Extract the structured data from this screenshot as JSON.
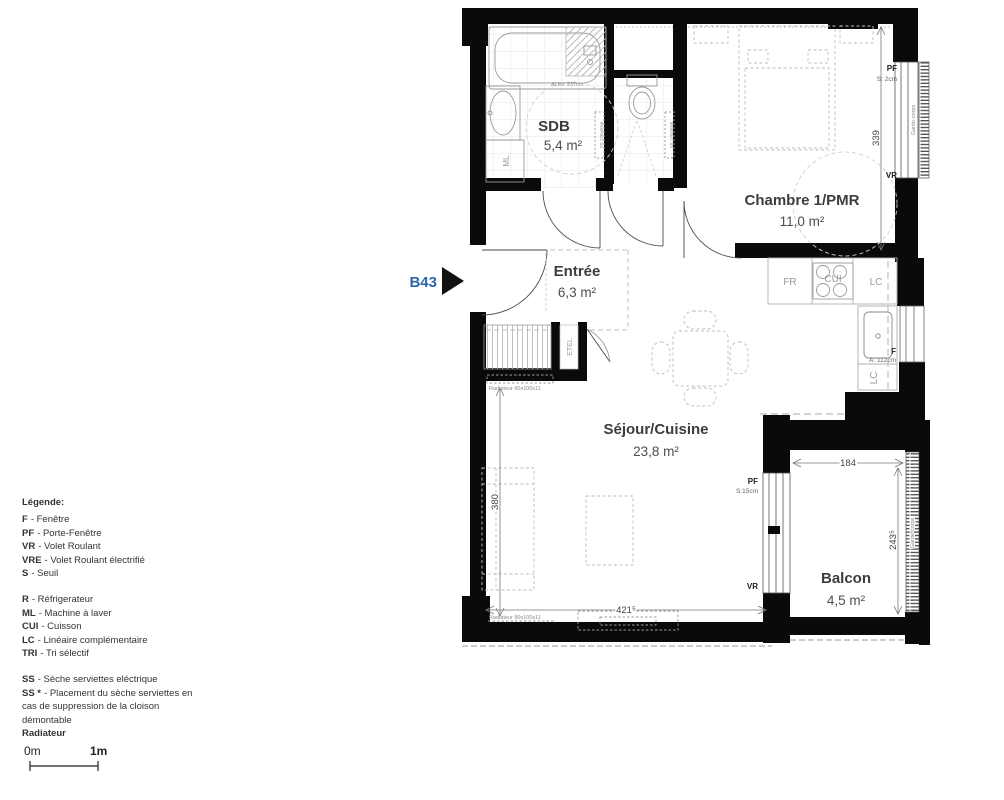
{
  "plan": {
    "unit": "B43",
    "rooms": {
      "sdb": {
        "name": "SDB",
        "area": "5,4 m²"
      },
      "chambre": {
        "name": "Chambre 1/PMR",
        "area": "11,0 m²"
      },
      "entree": {
        "name": "Entrée",
        "area": "6,3 m²"
      },
      "sejour": {
        "name": "Séjour/Cuisine",
        "area": "23,8 m²"
      },
      "balcon": {
        "name": "Balcon",
        "area": "4,5 m²"
      }
    },
    "dims": {
      "bedroom_height": "339",
      "sejour_height": "380",
      "sejour_width": "421⁵",
      "balcon_width": "184",
      "balcon_height": "243⁵"
    },
    "annotations": {
      "window_sill_kitchen": "A: 112cm",
      "threshold_bedroom": "S: 2cm",
      "threshold_sejour": "S:15cm",
      "alim": "ALIM: 237cm",
      "pf_bedroom": "PF",
      "vr_bedroom": "VR",
      "pf_sejour": "PF",
      "vr_sejour": "VR",
      "f_kitchen": "F",
      "fr": "FR",
      "cui": "CUI",
      "lc_top": "LC",
      "lc_side": "LC",
      "ml": "ML",
      "etel": "ETEL",
      "garde_corps_bedroom": "Garde-corps",
      "garde_corps_balcon": "Garde-corps",
      "radiateur_1": "Radiateur 90x100x11",
      "radiateur_2": "Radiateur 90x100x11",
      "ss_left": "SS 170x60x6",
      "ss_right": "SS 170x60x6"
    }
  },
  "legend": {
    "title": "Légende:",
    "items": [
      {
        "code": "F",
        "label": "- Fenêtre"
      },
      {
        "code": "PF",
        "label": "- Porte-Fenêtre"
      },
      {
        "code": "VR",
        "label": "- Volet Roulant"
      },
      {
        "code": "VRE",
        "label": "- Volet Roulant électrifié"
      },
      {
        "code": "S",
        "label": "- Seuil"
      },
      {
        "code": "R",
        "label": "- Réfrigerateur"
      },
      {
        "code": "ML",
        "label": "- Machine à laver"
      },
      {
        "code": "CUI",
        "label": "- Cuisson"
      },
      {
        "code": "LC",
        "label": "- Linéaire complémentaire"
      },
      {
        "code": "TRI",
        "label": "- Tri sélectif"
      },
      {
        "code": "SS",
        "label": "- Sèche serviettes eléctrique"
      },
      {
        "code": "SS *",
        "label": "- Placement du sèche serviettes en cas de suppression de la cloison démontable"
      },
      {
        "code": "Radiateur",
        "label": ""
      }
    ]
  },
  "scale_bar": {
    "start": "0m",
    "end": "1m"
  },
  "colors": {
    "wall": "#0a0a0a",
    "unit_accent": "#2b66ad"
  }
}
